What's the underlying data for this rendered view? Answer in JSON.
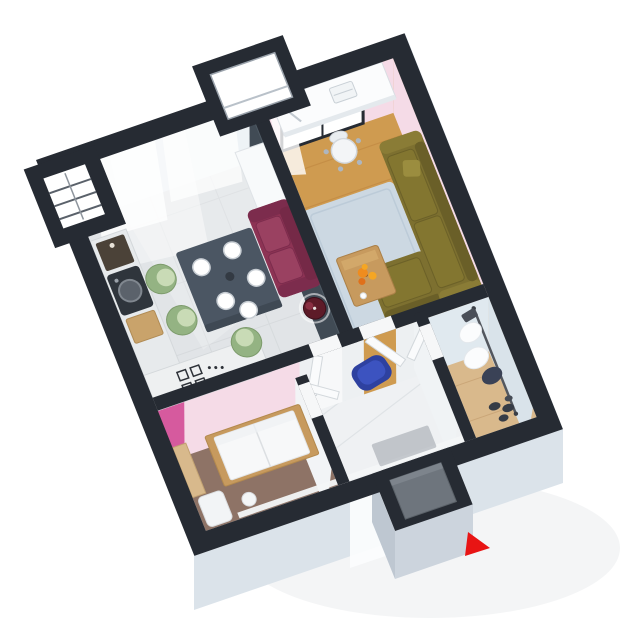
{
  "scene": {
    "type": "3d-floor-plan",
    "view": "isometric-top",
    "rooms": [
      {
        "id": "kitchen-dining",
        "floor": "gray-tile"
      },
      {
        "id": "living-room",
        "floor": "oak-wood"
      },
      {
        "id": "bedroom",
        "floor": "brown-carpet"
      },
      {
        "id": "hallway",
        "floor": "white-tile"
      },
      {
        "id": "walk-in-closet",
        "floor": "light-wood"
      },
      {
        "id": "balcony-window-bays",
        "floor": ""
      },
      {
        "id": "entrance-vestibule",
        "floor": ""
      }
    ],
    "furniture": [
      "kitchen-counter-with-sink",
      "coffee-machine",
      "cutting-board",
      "cooktop",
      "tall-cabinet",
      "dining-table",
      "dinner-plates",
      "green-tub-chairs",
      "maroon-loveseat",
      "floor-lamp",
      "desk",
      "desk-lamp",
      "laptop",
      "office-chair",
      "olive-sectional-sofa",
      "throw-pillow",
      "blue-rug",
      "coffee-table",
      "orange-flowers",
      "wall-painting",
      "bed-with-wood-frame",
      "wardrobe-panel",
      "bench",
      "stool",
      "blue-pouf",
      "door-leaves",
      "entry-door",
      "doormat",
      "clothes-rail",
      "hanging-clothes",
      "shoes",
      "window-curtains",
      "balcony-railing"
    ],
    "cursor": {
      "shape": "right-pointing-triangle",
      "color": "#e81414"
    },
    "colors": {
      "background": "#ffffff",
      "wall": "#262b33",
      "wall_face_white": "#eef3f6",
      "wall_face_pink": "#f5dbe7",
      "magenta_accent": "#d65a9e",
      "divider_face": "#414b55",
      "window_glass": "#ffffff",
      "curtain": "#ffffff",
      "ext_face_light": "#e9eef3",
      "ext_face_mid": "#dbe3ea",
      "ext_face_front": "#ccd4dd",
      "ext_face_side": "#bec7d1",
      "floor_kitchen": "#e1e4e7",
      "floor_living": "#cf9b50",
      "floor_living_line": "#b97f3a",
      "floor_bedroom": "#8e7366",
      "floor_hall": "#eff1f3",
      "floor_closet": "#d9b98c",
      "face_hall": "#edf0f2",
      "face_closet": "#e0e9ef",
      "face_closet_right": "#d9e3ea",
      "face_white_soft": "#f2f4f6",
      "baseboard": "#f3f5f7",
      "sofa_olive": "#7d7030",
      "sofa_olive_dark": "#6a5f28",
      "sofa_olive_light": "#8a7c36",
      "sofa_olive_cushion": "#837630",
      "sofa_maroon": "#8d3354",
      "sofa_maroon_dark": "#752947",
      "sofa_maroon_cushion": "#9a4161",
      "chair_green": "#94b383",
      "chair_green_light": "#c9dbb6",
      "table_dark": "#4b5663",
      "plate": "#ffffff",
      "rug": "#ccd8e2",
      "wood": "#c79a5e",
      "flower": "#ef8c1e",
      "flower_light": "#f5a623",
      "pouf": "#2e41a0",
      "pouf_light": "#3d54c2",
      "lamp_shade": "#5d1b28",
      "desk": "#fbfcfd",
      "bed": "#f7f8f9",
      "door_leaf": "#fafbfc",
      "entry_door": "#6e757d",
      "mat": "#8a9098",
      "clothes_dark": "#3a4256",
      "clothes_white": "#fbfcfd",
      "counter": "#e7eaec",
      "counter_white": "#eef0f1",
      "sink_dark": "#2f353c",
      "appliance_dark": "#4b4238",
      "board_wood": "#c9a36b",
      "cabinet_white": "#f8fafb",
      "painting_yellow": "#e8c24a",
      "painting_orange": "#d2802e",
      "painting_red": "#a8402a",
      "cursor_red": "#e81414"
    }
  }
}
